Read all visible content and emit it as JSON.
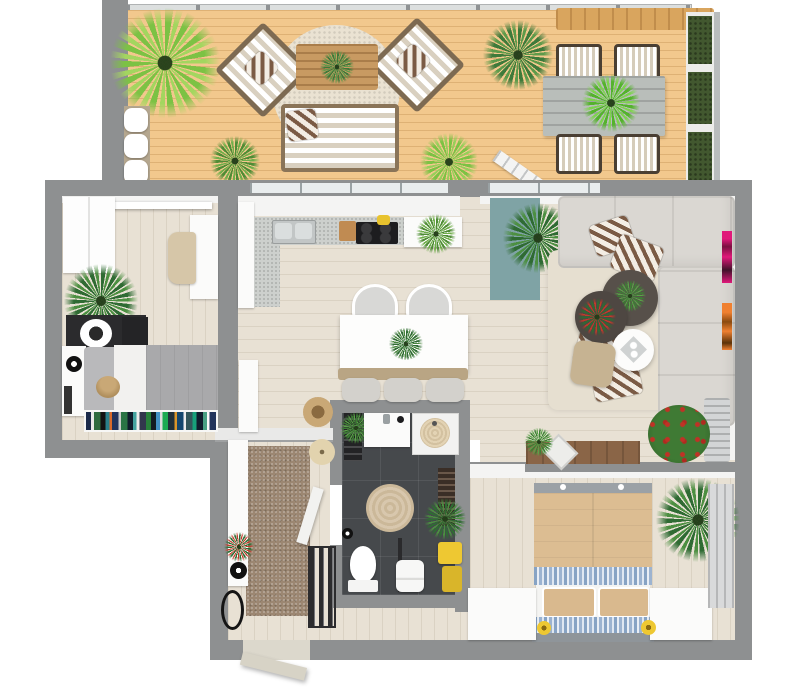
{
  "meta": {
    "title": "3D Apartment Floor Plan",
    "description": "Top-down 3D rendered floor plan of a one/two-bedroom apartment with large terrace"
  },
  "colors": {
    "paper": "#ffffff",
    "wall": "#8e9091",
    "wallface": "#f4f4f3",
    "deck": "#f2c88d",
    "floor": "#e8e1d4",
    "bathfloor": "#46494c",
    "granite": "#cdd0cd",
    "gravel": "#eae2d2",
    "sofa": "#dad7d2",
    "teal": "#7fa3a5",
    "rugbeige": "#e6dfd0",
    "runner": "#9c8772",
    "woodlight": "#c89a62",
    "sideboardwood": "#8a6547",
    "bedtan": "#dcbd92",
    "pillowa": "#7b5b45",
    "pillowb": "#f3ede4",
    "yellow": "#eec832",
    "pink": "#e0187a",
    "orange": "#f08030",
    "tabledark": "#57504a"
  },
  "rooms": [
    {
      "id": "terrace",
      "name": "Terrace"
    },
    {
      "id": "office",
      "name": "Office / Guest Room"
    },
    {
      "id": "kitchen",
      "name": "Kitchen & Dining"
    },
    {
      "id": "living",
      "name": "Living Room"
    },
    {
      "id": "bathroom",
      "name": "Bathroom"
    },
    {
      "id": "hallway",
      "name": "Hallway / Entry"
    },
    {
      "id": "bedroom",
      "name": "Bedroom"
    }
  ],
  "furniture": {
    "terrace": [
      "palm plants",
      "two diagonal lounge chairs with striped cushions",
      "round gravel rug",
      "wood slat coffee table",
      "striped outdoor sofa",
      "bench with white cushions",
      "gray plank dining table",
      "four striped deck chairs",
      "vertical garden planters",
      "pergola beam",
      "ladder"
    ],
    "office": [
      "white wardrobe",
      "white desk",
      "beige chair",
      "palm plant",
      "black dresser with round lamp",
      "gray daybed",
      "teddy bear",
      "colorful bookshelf",
      "side shelf"
    ],
    "kitchen": [
      "L-shaped granite counter",
      "double sink",
      "black cooktop",
      "white dining island with plant",
      "two white chairs",
      "bench with three gray cushions",
      "tall white cabinet",
      "rope basket"
    ],
    "living": [
      "L-shaped gray corner sofa",
      "four striped pillows",
      "two dark round coffee tables with plants",
      "white round side table",
      "beige pouf",
      "large beige rug",
      "teal runner rug",
      "palm plant",
      "pink wall art",
      "orange wall art",
      "flower bush",
      "wood sideboard with picture frame",
      "gray basket"
    ],
    "bathroom": [
      "white vanity",
      "shower with beige mat",
      "black towel shelf with plant",
      "round beige rug",
      "dark towel rack",
      "toilet",
      "white stool",
      "yellow towels",
      "plant"
    ],
    "hallway": [
      "brown runner rug",
      "white console with plant",
      "black decor bowl",
      "oval floor vase",
      "beige stool",
      "black radiator",
      "open bathroom door",
      "entry door"
    ],
    "bedroom": [
      "double bed with tan duvet and blue patterned sheets",
      "two tan pillows",
      "two white nightstands",
      "yellow bedside lamps",
      "palm plant",
      "radiator panel"
    ]
  }
}
